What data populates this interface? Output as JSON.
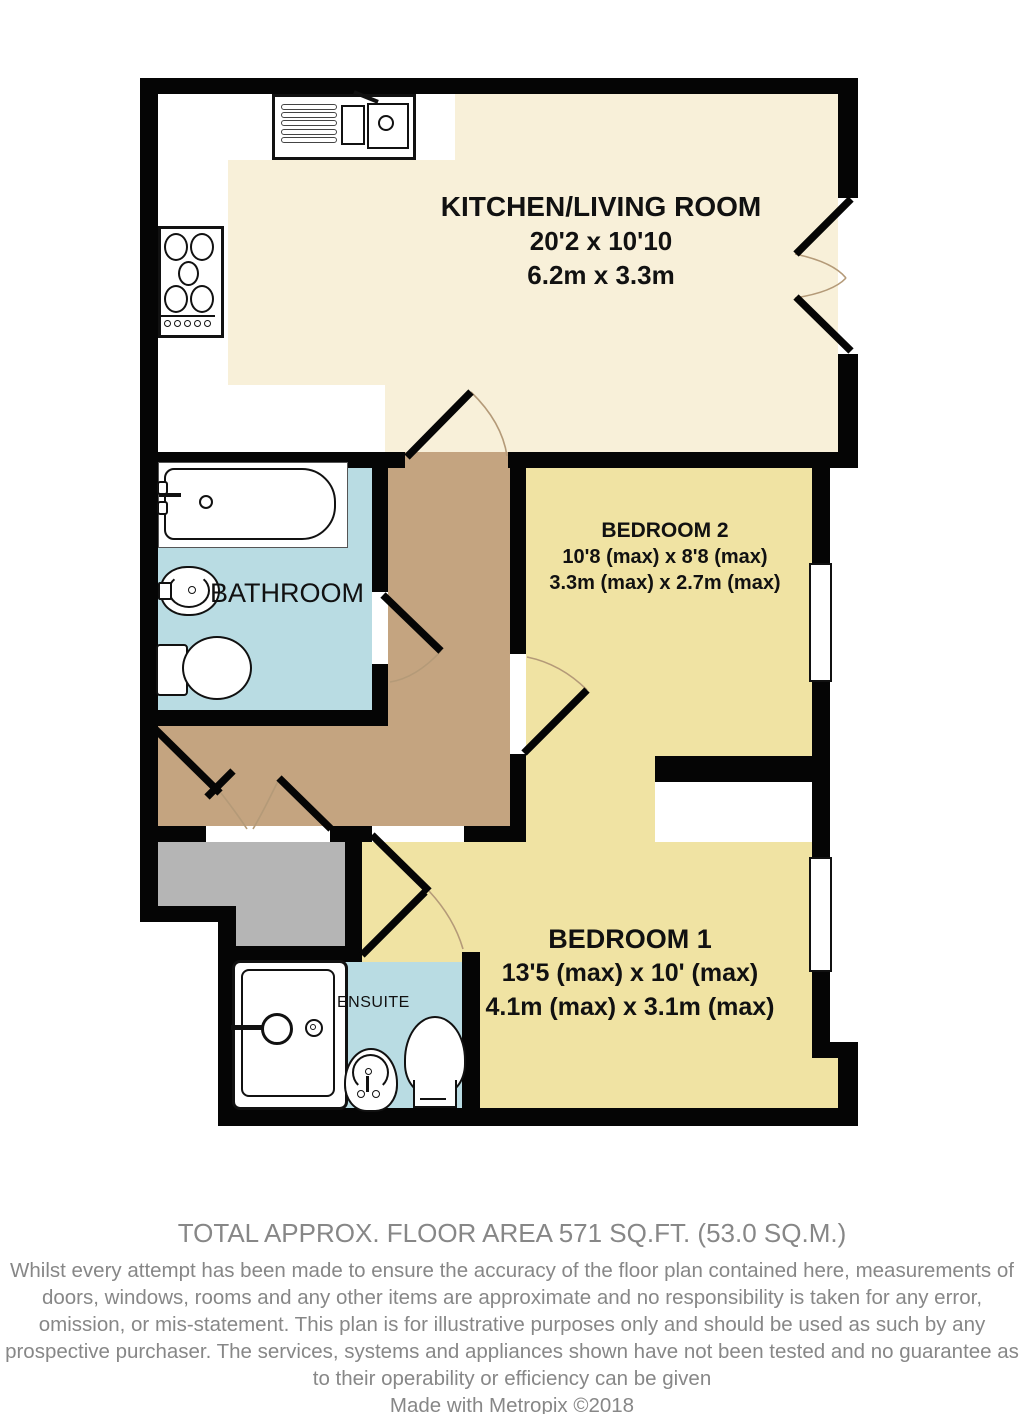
{
  "plan": {
    "title": "Two bedroom apartment floor plan",
    "colors": {
      "kitchen_floor": "#f8f0d9",
      "bedroom_floor": "#f0e3a3",
      "bathroom_floor": "#b9dce3",
      "hallway_floor": "#c4a480",
      "landing_floor": "#b5b5b5",
      "wall": "#050505",
      "footer_text": "#878787"
    },
    "rooms": [
      {
        "id": "kitchen-living",
        "name": "KITCHEN/LIVING ROOM",
        "dims_imperial": "20'2 x 10'10",
        "dims_metric": "6.2m x 3.3m"
      },
      {
        "id": "bedroom-2",
        "name": "BEDROOM 2",
        "dims_imperial": "10'8 (max) x 8'8 (max)",
        "dims_metric": "3.3m (max) x 2.7m (max)"
      },
      {
        "id": "bedroom-1",
        "name": "BEDROOM 1",
        "dims_imperial": "13'5 (max) x 10' (max)",
        "dims_metric": "4.1m (max) x 3.1m (max)"
      },
      {
        "id": "bathroom",
        "name": "BATHROOM"
      },
      {
        "id": "ensuite",
        "name": "ENSUITE"
      }
    ],
    "fixtures": [
      "kitchen-sink-drainer-unit",
      "hob-cooktop",
      "bathtub",
      "bathroom-washbasin",
      "bathroom-toilet",
      "shower-tray",
      "ensuite-washbasin",
      "ensuite-toilet"
    ],
    "openings": {
      "windows": 2,
      "door_swings": 8,
      "french_doors_room": "KITCHEN/LIVING ROOM"
    }
  },
  "footer": {
    "area_line": "TOTAL APPROX. FLOOR AREA 571 SQ.FT. (53.0 SQ.M.)",
    "disclaimer": "Whilst every attempt has been made to ensure the accuracy of the floor plan contained here, measurements of doors, windows, rooms and any other items are approximate and no responsibility is taken for any error, omission, or mis-statement. This plan is for illustrative purposes only and should be used as such by any prospective purchaser. The services, systems and appliances shown have not been tested and no guarantee as to their operability or efficiency can be given",
    "credit": "Made with Metropix ©2018"
  }
}
